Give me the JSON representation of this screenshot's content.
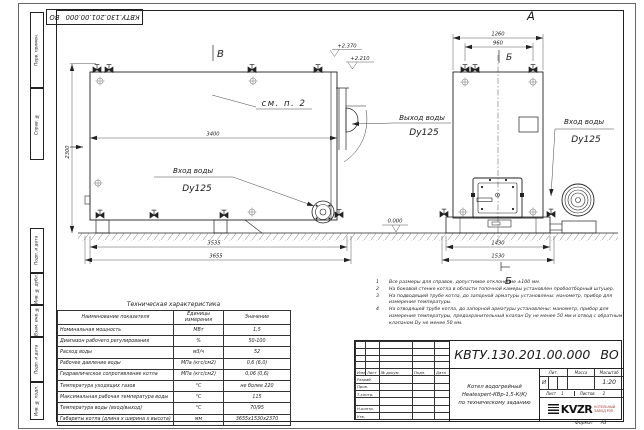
{
  "stamp": {
    "code": "КВТУ.130.201.00.000 ВО"
  },
  "sidebar": {
    "labels": [
      "Перв. примен.",
      "Справ. №",
      "Подп. и дата",
      "Инв. № дубл.",
      "Взам. инв. №",
      "Подп. и дата",
      "Инв. № подл."
    ]
  },
  "drawing": {
    "views": {
      "top_mark": "В",
      "front_view": "А",
      "section_top": "Б",
      "section_bottom": "Б"
    },
    "callout_note": "см. п. 2",
    "levels": {
      "l1": "+2.370",
      "l2": "+2.210",
      "zero": "0.000"
    },
    "dims": {
      "d3400": "3400",
      "d2300": "2300",
      "d3535": "3535",
      "d3655": "3655",
      "d1260": "1260",
      "d960": "960",
      "d1430": "1430",
      "d1530": "1530"
    },
    "ports": {
      "outlet_label": "Выход воды",
      "outlet_dn": "Dy125",
      "inlet_label": "Вход воды",
      "inlet_dn": "Dy125",
      "inlet2_label": "Вход воды",
      "inlet2_dn": "Dy125"
    }
  },
  "notes": [
    {
      "num": "1",
      "text": "Все размеры для справок, допустимое отклонение ±100 мм."
    },
    {
      "num": "2",
      "text": "На боковой стенке котла в области топочной камеры установлен пробоотборный штуцер."
    },
    {
      "num": "3",
      "text": "На подводящей трубе котла, до запорной арматуры установлены: манометр, прибор для измерения температуры."
    },
    {
      "num": "4",
      "text": "На отводящей трубе котла, до запорной арматуры установлены: манометр, прибор для измерения температуры, предохранительный клапан Dу не менее 50 мм и отвод с обратным клапаном Dу не менее 50 мм."
    }
  ],
  "tech_table": {
    "title": "Техническая характеристика",
    "headers": [
      "Наименование показателя",
      "Единицы измерения",
      "Значение"
    ],
    "rows": [
      [
        "Номинальная мощность",
        "МВт",
        "1,5"
      ],
      [
        "Диапазон рабочего регулирования",
        "%",
        "50-100"
      ],
      [
        "Расход воды",
        "м3/ч",
        "52"
      ],
      [
        "Рабочее давление воды",
        "МПа (кгс/см2)",
        "0,6 (6,0)"
      ],
      [
        "Гидравлическое сопротивление котла",
        "МПа (кгс/см2)",
        "0,06 (0,6)"
      ],
      [
        "Температура уходящих газов",
        "°С",
        "не более 220"
      ],
      [
        "Максимальная рабочая температура воды",
        "°С",
        "115"
      ],
      [
        "Температура воды (вход/выход)",
        "°С",
        "70/95"
      ],
      [
        "Габариты котла (длина х ширина х высота)",
        "мм",
        "3655х1530х2370"
      ]
    ]
  },
  "title_block": {
    "designation": "КВТУ.130.201.00.000 ВО",
    "name_line1": "Котел водогрейный",
    "name_line2": "Heatexpert-КВр-1,5-К(К)",
    "name_line3": "по техническому заданию",
    "rev_headers": {
      "izm": "Изм",
      "list": "Лист",
      "doc": "№ докум.",
      "podp": "Подп.",
      "data": "Дата"
    },
    "sign_labels": {
      "razrab": "Разраб.",
      "prov": "Пров.",
      "tkontr": "Т.контр.",
      "nkontr": "Н.контр.",
      "utv": "Утв."
    },
    "lit_header": "Лит.",
    "mass_header": "Масса",
    "scale_header": "Масштаб",
    "lit_value": "И",
    "scale_value": "1:20",
    "sheet_label": "Лист",
    "sheet_value": "1",
    "sheets_label": "Листов",
    "sheets_value": "2",
    "logo": {
      "text": "KVZR",
      "sub1": "КОТЕЛЬНЫЙ",
      "sub2": "ЗАВОД РЭП"
    },
    "format_label": "Формат",
    "format_value": "А3"
  }
}
